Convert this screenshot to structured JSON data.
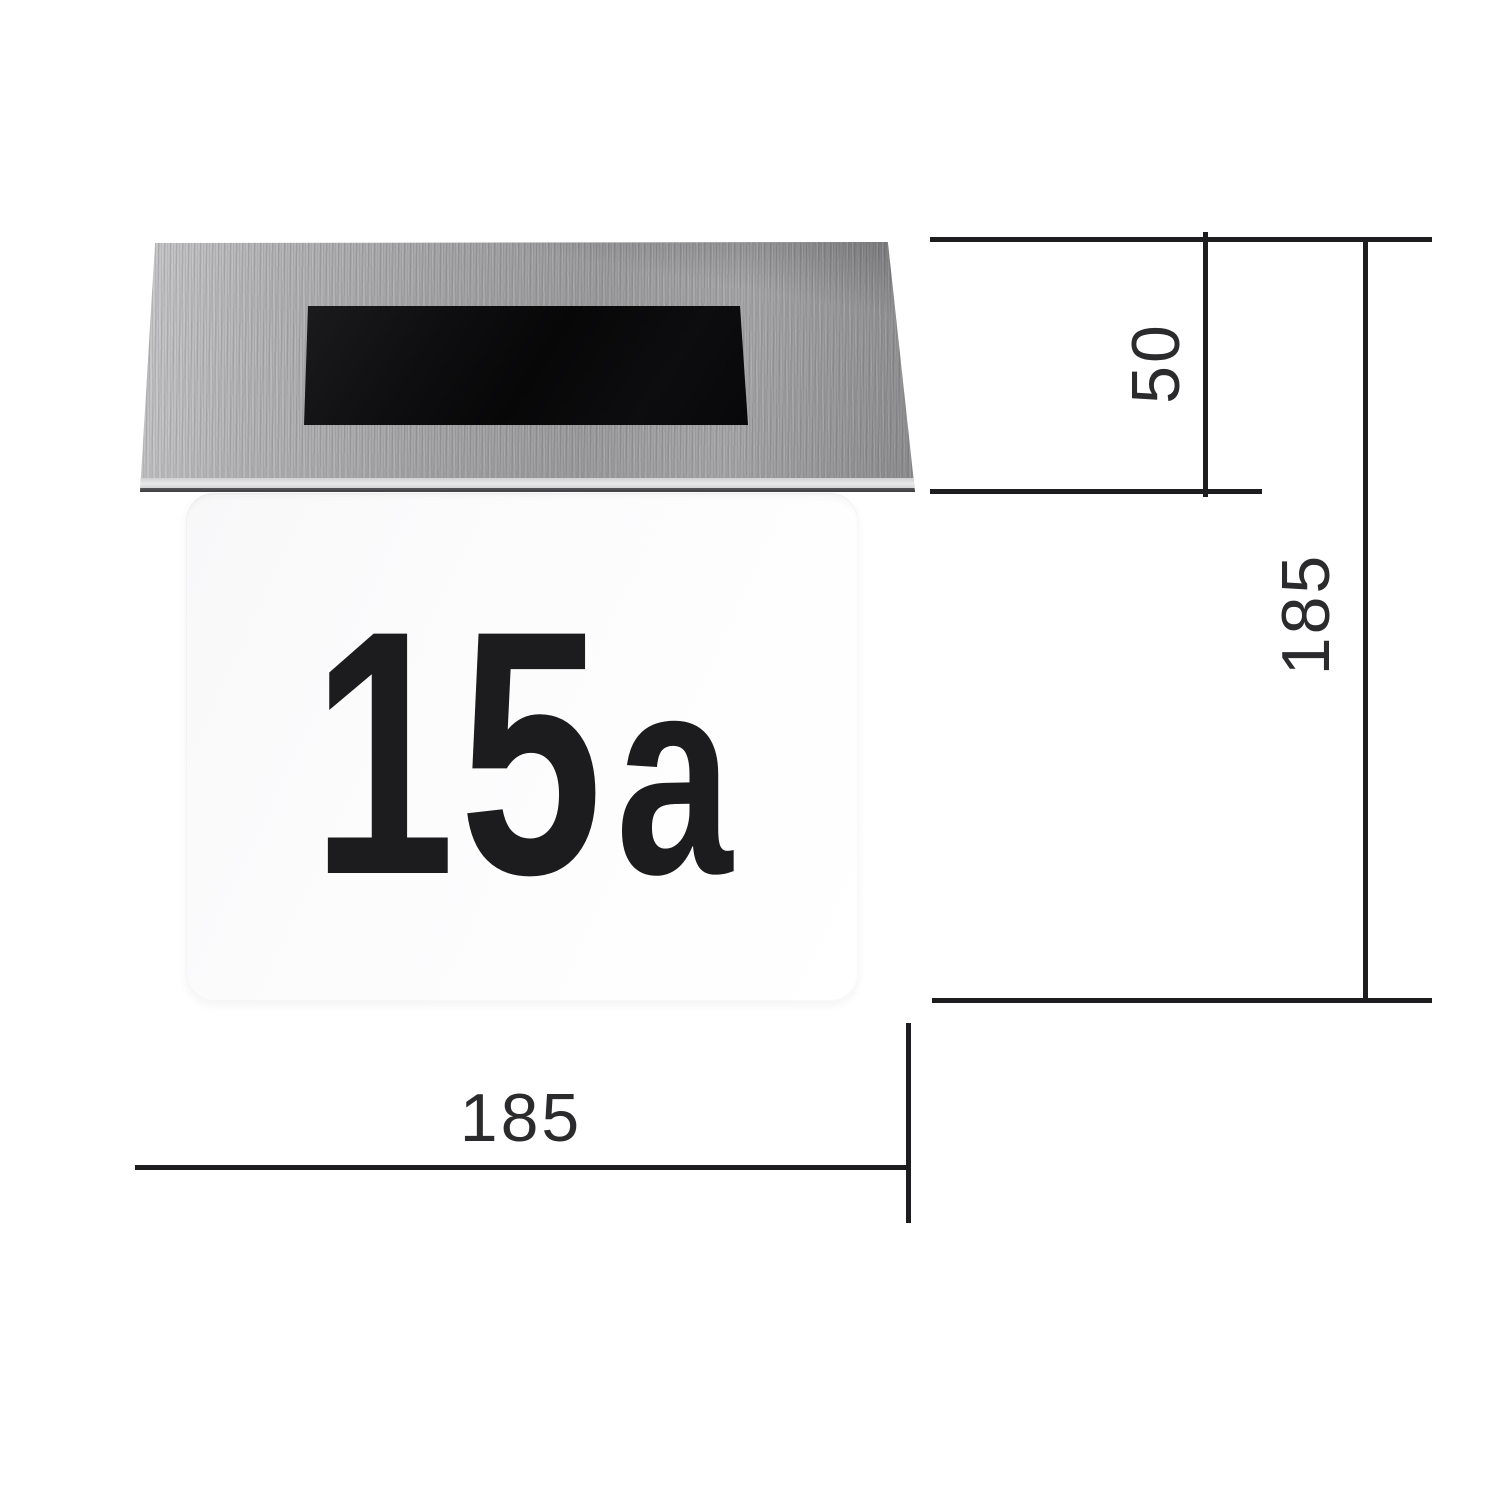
{
  "figure": {
    "kind": "product-dimension-diagram",
    "subject": "solar house number sign"
  },
  "product": {
    "house_number": "15a",
    "number_main": "15",
    "number_suffix": "a"
  },
  "dimensions": {
    "roof_height": "50",
    "total_height": "185",
    "total_width": "185"
  },
  "colors": {
    "background": "#ffffff",
    "steel_roof": "#a5a5a7",
    "roof_edge_dark": "#3e3e42",
    "solar_panel": "#0a0a0b",
    "number_plate": "#fcfcfd",
    "house_number_text": "#1c1c1e",
    "dimension_line": "#1d1d1f",
    "dimension_label_text": "#2b2b2d"
  }
}
